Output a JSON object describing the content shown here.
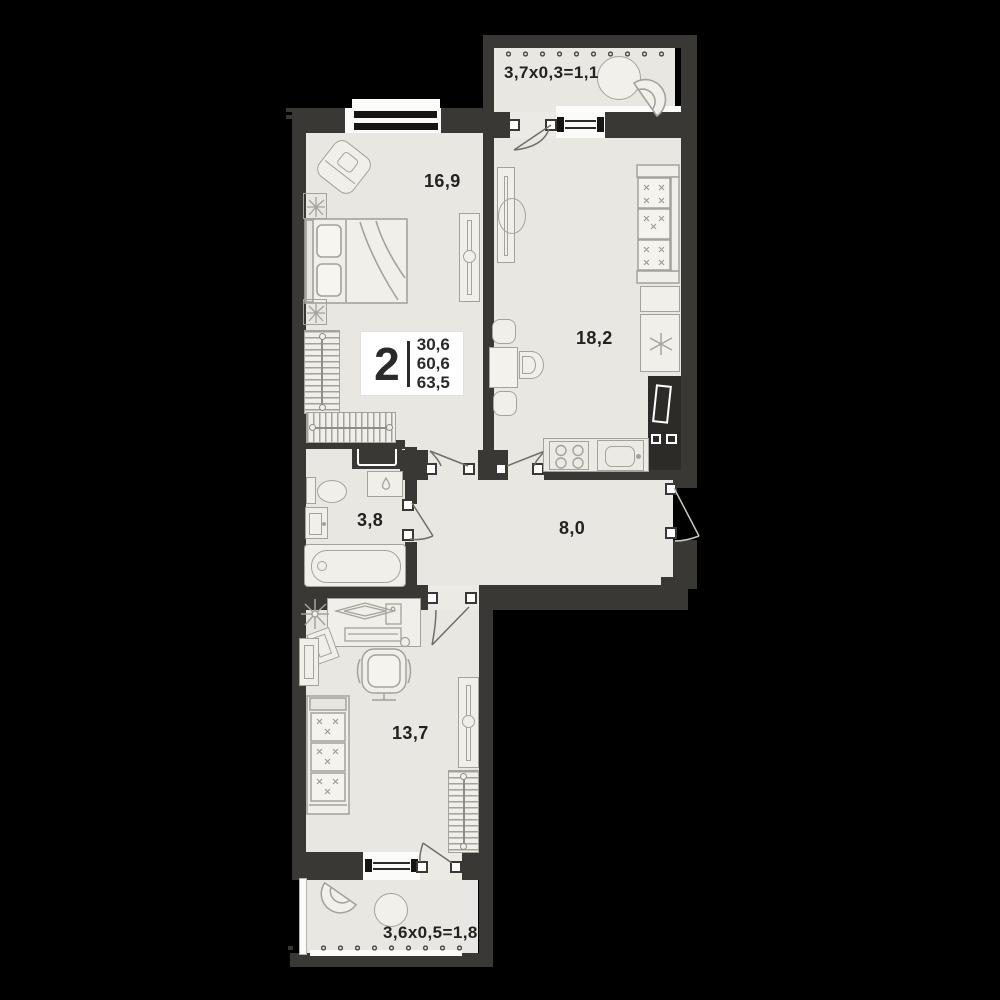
{
  "plan": {
    "info_card": {
      "rooms_count": "2",
      "areas": [
        "30,6",
        "60,6",
        "63,5"
      ]
    },
    "room_labels": {
      "bedroom": "16,9",
      "kitchen_living": "18,2",
      "bathroom": "3,8",
      "hallway": "8,0",
      "bedroom_second": "13,7",
      "balcony_top": "3,7x0,3=1,1",
      "balcony_bottom": "3,6x0,5=1,8"
    },
    "colors": {
      "background": "#000000",
      "wall": "#3a3834",
      "floor": "#e9e7e2",
      "furniture_line": "#a4a29a",
      "text": "#232220",
      "card_bg": "#ffffff"
    }
  }
}
